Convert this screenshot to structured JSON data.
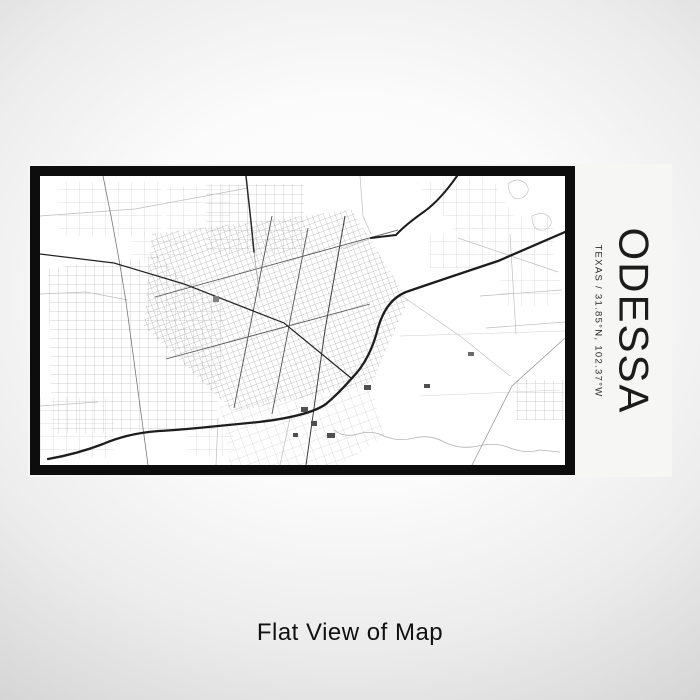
{
  "product": {
    "caption": "Flat View of Map"
  },
  "label": {
    "city": "ODESSA",
    "subtitle": "TEXAS  /  31.85°N, 102.37°W",
    "state": "Texas",
    "latitude": "31.85°N",
    "longitude": "102.37°W"
  },
  "colors": {
    "background_center": "#ffffff",
    "background_edge": "#d2d2d2",
    "label_substrate": "#f6f6f4",
    "frame": "#0d0d0d",
    "map_background": "#ffffff",
    "road_dark": "#1d1d1d",
    "road_medium": "#555555",
    "road_light": "#bdbdbd",
    "title_text": "#1c1c1c",
    "caption_text": "#111111"
  },
  "map": {
    "name": "odessa-street-map",
    "style": "monochrome line map"
  }
}
